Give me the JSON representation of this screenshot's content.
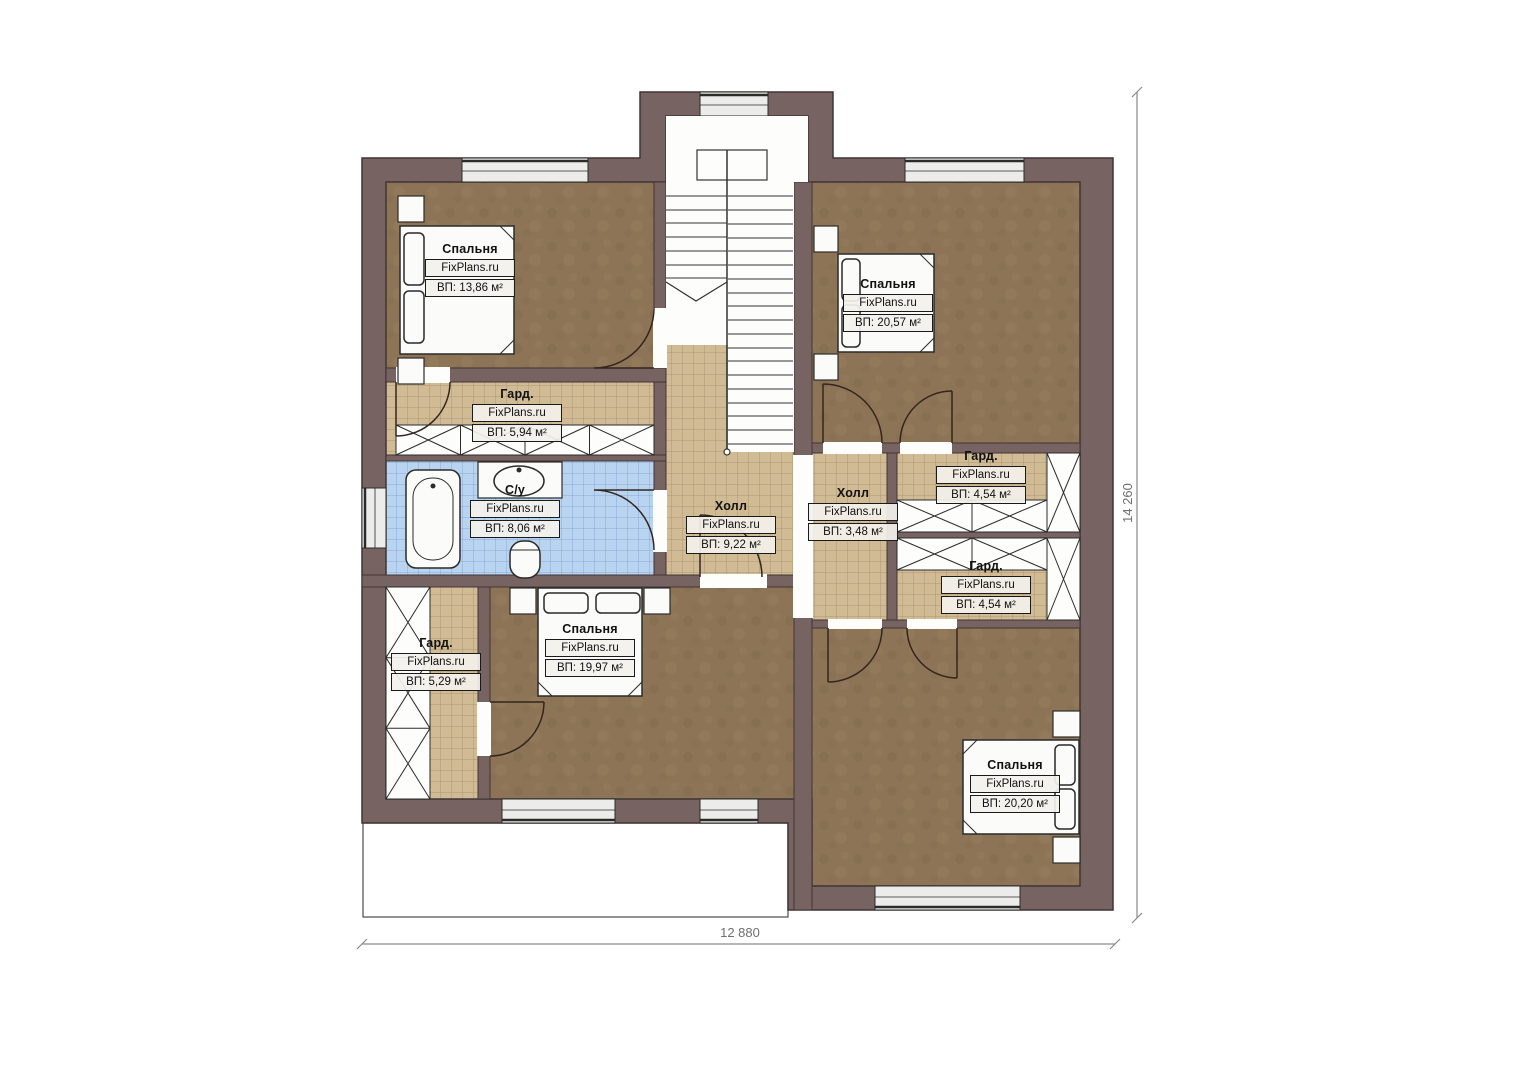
{
  "title": "План второго этажа",
  "brand": "FixPlans.ru",
  "rooms": [
    {
      "id": "bedroom-top-left",
      "name": "Спальня",
      "brand": "FixPlans.ru",
      "area": "ВП: 13,86 м²"
    },
    {
      "id": "bedroom-top-right",
      "name": "Спальня",
      "brand": "FixPlans.ru",
      "area": "ВП: 20,57 м²"
    },
    {
      "id": "wardrobe-left",
      "name": "Гард.",
      "brand": "FixPlans.ru",
      "area": "ВП: 5,94 м²"
    },
    {
      "id": "bathroom",
      "name": "С/у",
      "brand": "FixPlans.ru",
      "area": "ВП: 8,06 м²"
    },
    {
      "id": "hall-center",
      "name": "Холл",
      "brand": "FixPlans.ru",
      "area": "ВП: 9,22 м²"
    },
    {
      "id": "hall-right",
      "name": "Холл",
      "brand": "FixPlans.ru",
      "area": "ВП: 3,48 м²"
    },
    {
      "id": "wardrobe-right-upper",
      "name": "Гард.",
      "brand": "FixPlans.ru",
      "area": "ВП: 4,54 м²"
    },
    {
      "id": "wardrobe-right-lower",
      "name": "Гард.",
      "brand": "FixPlans.ru",
      "area": "ВП: 4,54 м²"
    },
    {
      "id": "wardrobe-bottom-left",
      "name": "Гард.",
      "brand": "FixPlans.ru",
      "area": "ВП: 5,29 м²"
    },
    {
      "id": "bedroom-bottom-middle",
      "name": "Спальня",
      "brand": "FixPlans.ru",
      "area": "ВП: 19,97 м²"
    },
    {
      "id": "bedroom-bottom-right",
      "name": "Спальня",
      "brand": "FixPlans.ru",
      "area": "ВП: 20,20 м²"
    }
  ],
  "dimensions": {
    "width": "12 880",
    "height": "14 260"
  },
  "colors": {
    "wall": "#786363",
    "wall_stroke": "#403434",
    "floor_bedroom": "#8d7456",
    "tile_hall": "#d1bb95",
    "tile_bath": "#b9d4f1",
    "window": "#ececea",
    "white": "#fdfdfc",
    "line": "#2b2b2b",
    "dim": "#8a8a8a"
  }
}
